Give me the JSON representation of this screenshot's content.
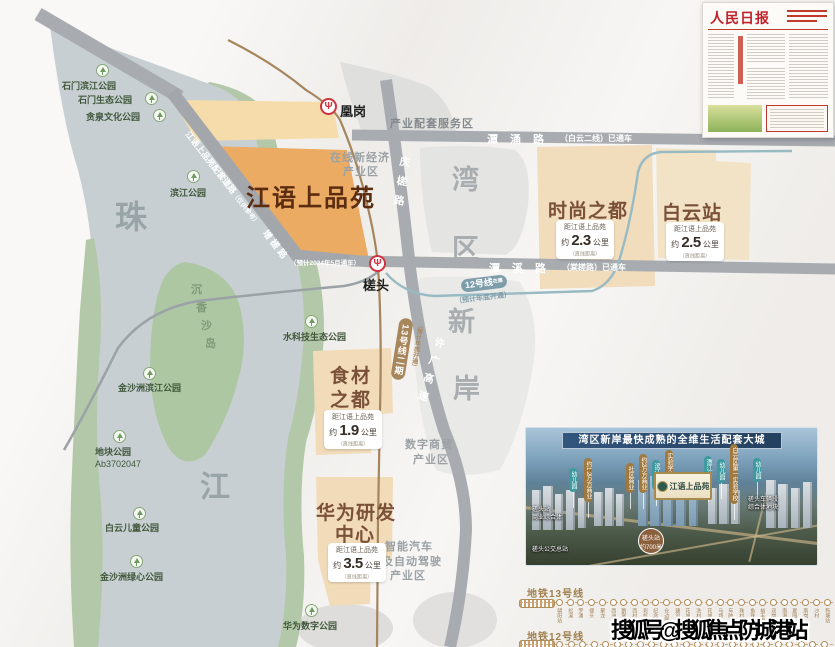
{
  "map": {
    "project_label": "江语上品苑",
    "water_chars": {
      "zhu": "珠",
      "jiang": "江"
    },
    "island": {
      "c1": "沉",
      "c2": "香",
      "c3": "沙",
      "c4": "岛"
    },
    "zones": {
      "wan": "湾",
      "qu": "区",
      "xin": "新",
      "an": "岸"
    },
    "stations": {
      "huanggang": "凰岗",
      "chatou": "槎头",
      "logo_glyph": "Ψ"
    },
    "roads": {
      "tanyong_name": "潭涌路",
      "tanyong_status": "（白云二线）已通车",
      "tanxi_name": "潭溪路",
      "tanxi_status": "（棠槎路）已通车",
      "qingcha": "庆槎路",
      "xuguang": "许广高速",
      "peitao": "江语上品苑配套道路",
      "peitao_note": "（仅供参考）",
      "zengcha": "增槎路",
      "open_2024": "（预计2024年5月通车）"
    },
    "metro": {
      "line12_label": "12号线",
      "line12_tag": "在建",
      "line12_note": "（预计年底开通）",
      "line13_label": "13号线二期",
      "line13_note": "（预计年底开通）"
    },
    "districts": {
      "chanye": "产业配套服务区",
      "zaixian_1": "在线新经济",
      "zaixian_2": "产业区",
      "shuzi_1": "数字商贸",
      "shuzi_2": "产业区",
      "zhineng_1": "智能汽车",
      "zhineng_2": "及自动驾驶",
      "zhineng_3": "产业区"
    },
    "parks": [
      {
        "name": "石门滨江公园"
      },
      {
        "name": "石门生态公园"
      },
      {
        "name": "贪泉文化公园"
      },
      {
        "name": "滨江公园"
      },
      {
        "name": "水科技生态公园"
      },
      {
        "name": "金沙洲滨江公园"
      },
      {
        "name": "地块公园",
        "code": "Ab3702047"
      },
      {
        "name": "白云儿童公园"
      },
      {
        "name": "金沙洲绿心公园"
      },
      {
        "name": "华为数字公园"
      }
    ],
    "destinations": {
      "dist_label": "距江语上品苑",
      "approx": "约",
      "unit": "公里",
      "note": "（直线距离）",
      "shishang": {
        "name": "时尚之都",
        "km": "2.3"
      },
      "baiyun": {
        "name": "白云站",
        "km": "2.5"
      },
      "shicai_1": "食材",
      "shicai_2": "之都",
      "shicai_km": "1.9",
      "huawei_1": "华为研发",
      "huawei_2": "中心",
      "huawei_km": "3.5"
    }
  },
  "newspaper": {
    "masthead": "人民日报"
  },
  "aerial": {
    "banner": "湾区新岸最快成熟的全维生活配套大城",
    "plaque": "江语上品苑",
    "tags": [
      "幼儿园",
      "约1.2万方商业",
      "社区商业",
      "约2万方商业",
      "滨江公园",
      "实验学校",
      "潭江公园",
      "幼儿园",
      "白云区第一实验学校",
      "幼儿园"
    ],
    "label_chatou_hub_1": "槎头站",
    "label_chatou_hub_2": "商业综合体",
    "label_bus": "槎头公交总站",
    "label_depot_1": "槎头车辆段",
    "label_depot_2": "综合体地块",
    "badge_1": "槎头站",
    "badge_2": "约700米"
  },
  "metro13": {
    "title": "地铁13号线",
    "stations": [
      "朝阳站",
      "松溪",
      "罗涌",
      "槎头",
      "聚龙",
      "西洲",
      "鹅掌坦",
      "西村",
      "彩虹桥",
      "纪念堂",
      "仓边路",
      "建设六马路",
      "花城广场北",
      "冼村",
      "花城大道东",
      "马场",
      "车陂",
      "珠村",
      "鱼珠",
      "裕丰围",
      "双岗",
      "南海神庙",
      "夏园",
      "南岗",
      "沙村",
      "新塘站"
    ]
  },
  "metro12": {
    "title": "地铁12号线",
    "dot_count": 24
  },
  "watermark": "搜狐号@搜狐焦点防城港站",
  "colors": {
    "parcel_orange": "#ecab63",
    "parcel_tan": "#f1dbb9",
    "river": "#c7cfd2",
    "park_green": "#b3c8a8",
    "metro_line13": "#a5855c",
    "metro_line12": "#97bac3",
    "station_red": "#cd3440",
    "dest_brown": "#7a5138",
    "banner_blue": "#2a4a6b"
  }
}
